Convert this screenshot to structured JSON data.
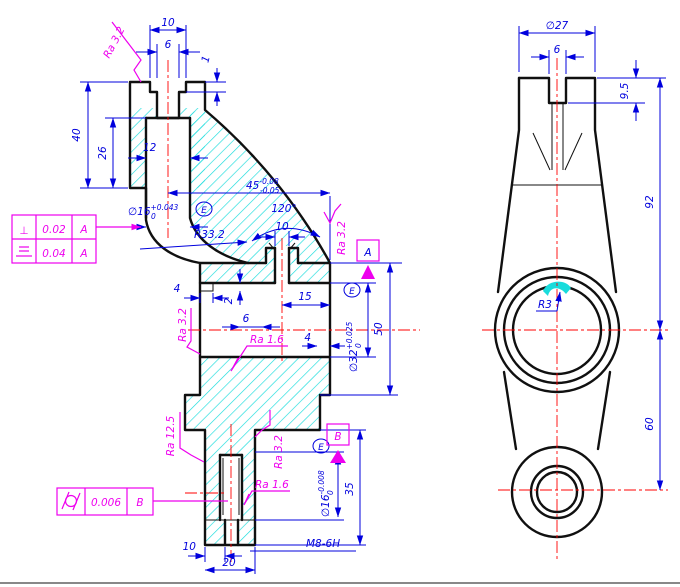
{
  "colors": {
    "outline": "#101010",
    "dimension": "#0000dd",
    "centerline": "#ff0000",
    "hatch": "#19dcdc",
    "annotation": "#ee00ee"
  },
  "left_view": {
    "dims": {
      "slot_width_outer": "10",
      "slot_width_inner": "6",
      "top_step": "1",
      "head_height": "40",
      "bore_depth": "26",
      "bore_width": "12",
      "length": {
        "value": "45",
        "upper": "-0.08",
        "lower": "-0.05"
      },
      "head_bore": {
        "value": "∅16",
        "upper": "+0.043",
        "lower": "0",
        "envelope": "E"
      },
      "fillet": "R33.2",
      "chamfer_angle": "120°",
      "chamfer_width": "10",
      "step_4": "4",
      "depth_2": "2",
      "width_6": "6",
      "offset_15": "15",
      "wall_4": "4",
      "main_bore": {
        "value": "∅32",
        "upper": "+0.025",
        "lower": "0",
        "envelope": "E"
      },
      "height_50": "50",
      "stem": {
        "value": "∅16",
        "upper": "-0.008",
        "lower": "0",
        "envelope": "E"
      },
      "height_35": "35",
      "bottom_10": "10",
      "bottom_20": "20",
      "thread": "M8-6H"
    },
    "roughness": {
      "top": "Ra 3.2",
      "right": "Ra 3.2",
      "mid_left": "Ra 3.2",
      "mid": "Ra 1.6",
      "lower_left": "Ra 12.5",
      "lower_right": "Ra 3.2",
      "bottom": "Ra 1.6"
    },
    "datums": {
      "a": "A",
      "b": "B"
    },
    "frames": {
      "upper": {
        "row1": {
          "symbol": "⊥",
          "value": "0.02",
          "datum": "A"
        },
        "row2": {
          "symbol": "symmetry",
          "value": "0.04",
          "datum": "A"
        }
      },
      "lower": {
        "symbol": "cylindricity",
        "value": "0.006",
        "datum": "B"
      }
    }
  },
  "right_view": {
    "dims": {
      "dia": "∅27",
      "slot_width": "6",
      "slot_depth": "9.5",
      "upper_height": "92",
      "lower_height": "60",
      "radius": "R3"
    }
  }
}
